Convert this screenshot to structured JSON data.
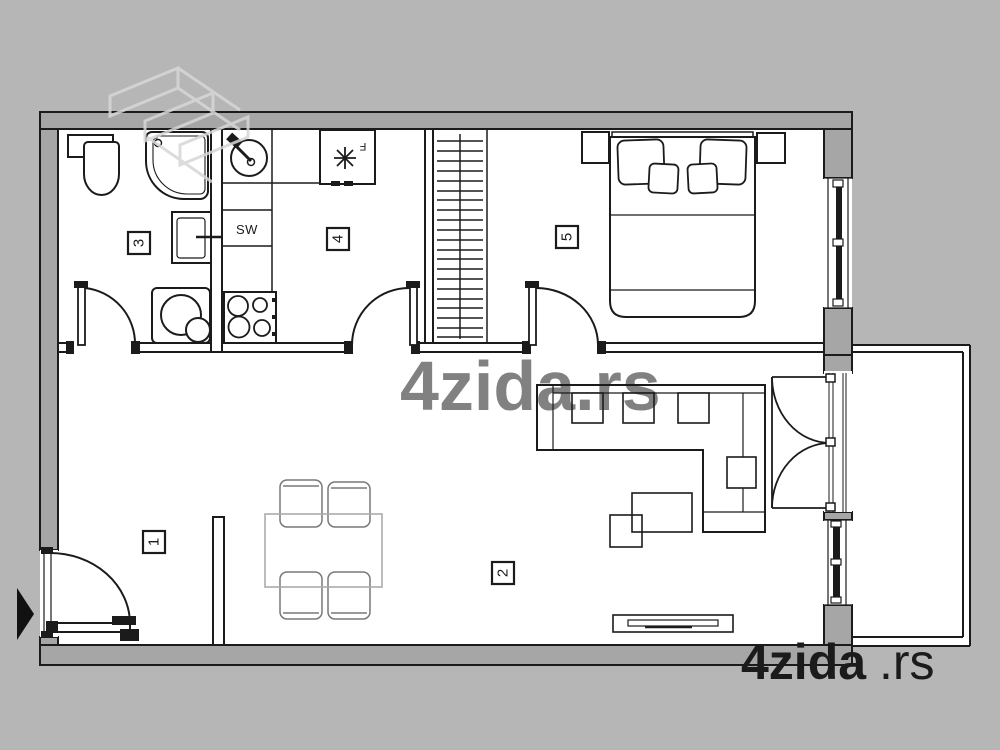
{
  "floor_plan": {
    "room_numbers": [
      "1",
      "2",
      "3",
      "4",
      "5"
    ],
    "labels": {
      "kitchen_unit": "SW",
      "fridge": "F"
    },
    "watermarks": {
      "bottom_right_brand": "4zida",
      "bottom_right_tld": ".rs",
      "center": "4zida.rs"
    },
    "icons": {
      "brand_logo": "4zida-angular-logo",
      "entrance_marker": "right-pointing-triangle",
      "freezer_symbol": "asterisk-star"
    },
    "colors": {
      "outside_background": "#b6b6b6",
      "wall_fill": "#a6a6a6",
      "line": "#1b1b1b",
      "interior": "#ffffff",
      "dining_set": "#9a9a9a",
      "watermark": "#cfcfcf"
    }
  }
}
